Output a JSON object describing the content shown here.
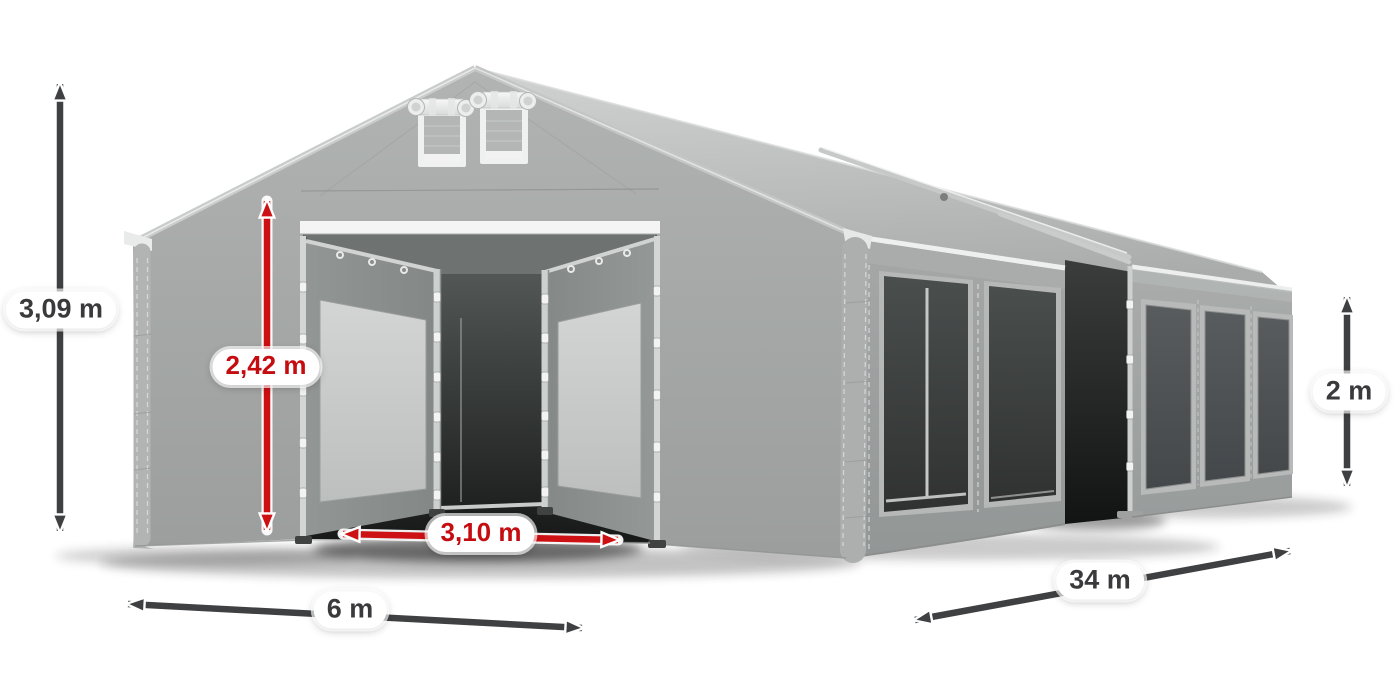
{
  "diagram": {
    "subject": "gray-marquee-tent-3d-render",
    "dimensions": {
      "total_height": {
        "label": "3,09 m",
        "style": "gray",
        "orientation": "vertical",
        "measures": "total-ridge-height"
      },
      "door_height": {
        "label": "2,42 m",
        "style": "red",
        "orientation": "vertical",
        "measures": "entrance-height"
      },
      "door_width": {
        "label": "3,10 m",
        "style": "red",
        "orientation": "horizontal",
        "measures": "entrance-width"
      },
      "front_width": {
        "label": "6 m",
        "style": "gray",
        "orientation": "horizontal",
        "measures": "tent-width"
      },
      "length": {
        "label": "34 m",
        "style": "gray",
        "orientation": "diagonal",
        "measures": "tent-length"
      },
      "side_height": {
        "label": "2 m",
        "style": "gray",
        "orientation": "vertical",
        "measures": "side-wall-height"
      }
    },
    "colors": {
      "accent_red": "#cc1013",
      "red_label_text": "#c50d11",
      "arrow_gray": "#3f4042",
      "gray_label_text": "#3a3a3c",
      "tent_gray": "#a6a9a8",
      "background": "#ffffff"
    }
  }
}
